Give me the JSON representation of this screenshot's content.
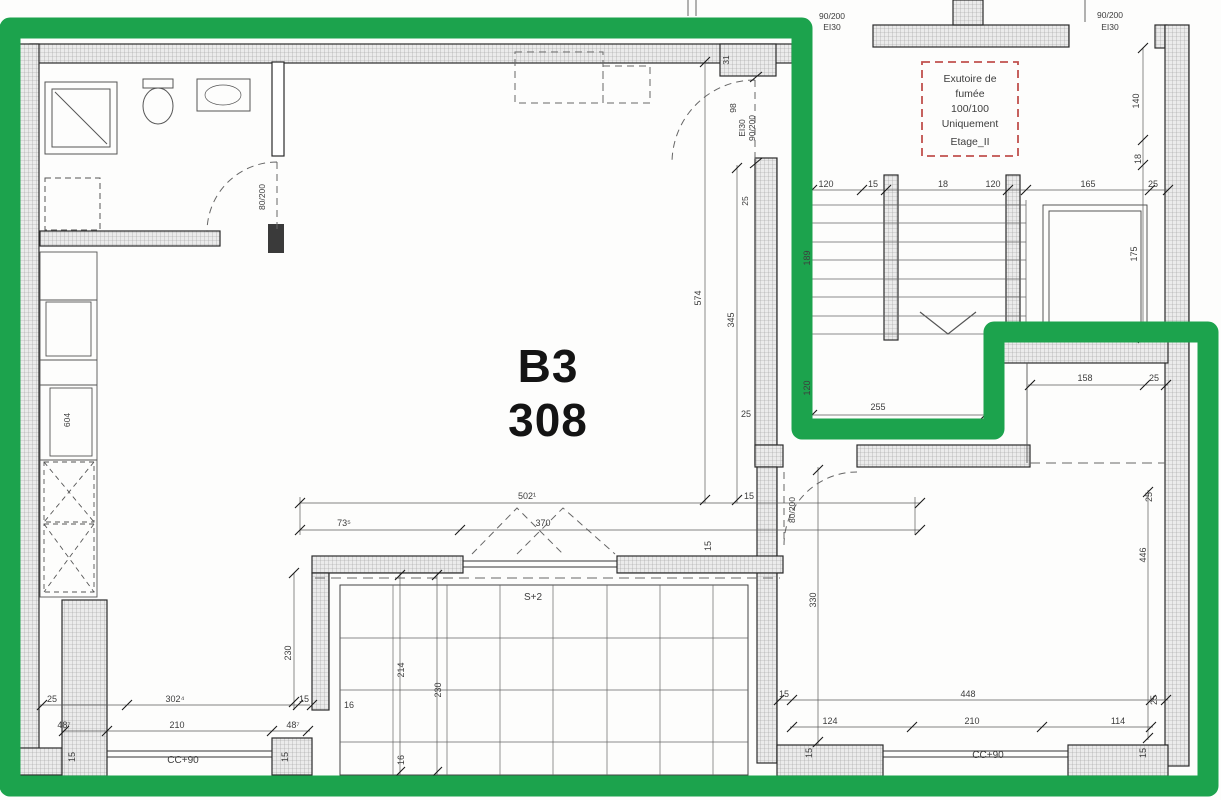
{
  "colors": {
    "highlight_green": "#1ca34d",
    "annotation_red": "#c0504d"
  },
  "unit": {
    "name": "B3",
    "number": "308"
  },
  "smoke_vent_note": {
    "line1": "Exutoire de",
    "line2": "fumée",
    "line3": "100/100",
    "line4": "Uniquement",
    "line5": "Etage_II"
  },
  "doors": {
    "bath": "80/200",
    "interior": "80/200",
    "entry_fire": "EI30",
    "entry_size": "90/200",
    "entry_width": "98",
    "landing_size": "90/200",
    "landing_fire": "EI30",
    "stair_size": "90/200",
    "stair_fire": "EI30"
  },
  "rooms": {
    "balcony_code": "S+2",
    "window_sill_left": "CC+90",
    "window_sill_right": "CC+90",
    "kitchen_unit": "604"
  },
  "dims": {
    "15": "15",
    "16": "16",
    "18": "18",
    "25": "25",
    "31": "31",
    "98": "98",
    "114": "114",
    "120": "120",
    "124": "124",
    "140": "140",
    "158": "158",
    "165": "165",
    "175": "175",
    "189": "189",
    "210": "210",
    "214": "214",
    "230": "230",
    "255": "255",
    "302": "302⁴",
    "330": "330",
    "345": "345",
    "370": "370",
    "446": "446",
    "448": "448",
    "487": "48⁷",
    "502": "502¹",
    "574": "574",
    "735": "73⁵"
  }
}
